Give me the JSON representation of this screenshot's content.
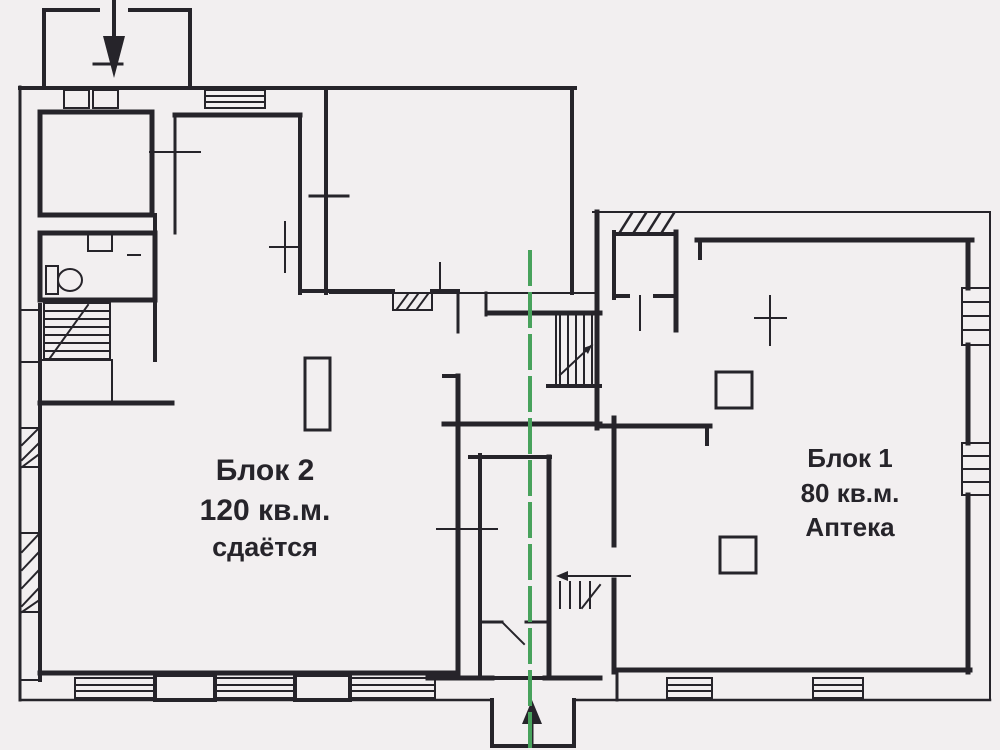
{
  "title": "Floor plan",
  "labels": {
    "block2": {
      "title": "Блок 2",
      "area": "120 кв.м.",
      "status": "сдаётся"
    },
    "block1": {
      "title": "Блок 1",
      "area": "80 кв.м.",
      "use": "Аптека"
    }
  },
  "colors": {
    "ink": "#26242a",
    "divider_green": "#48a25c",
    "background": "#f2eff0"
  }
}
